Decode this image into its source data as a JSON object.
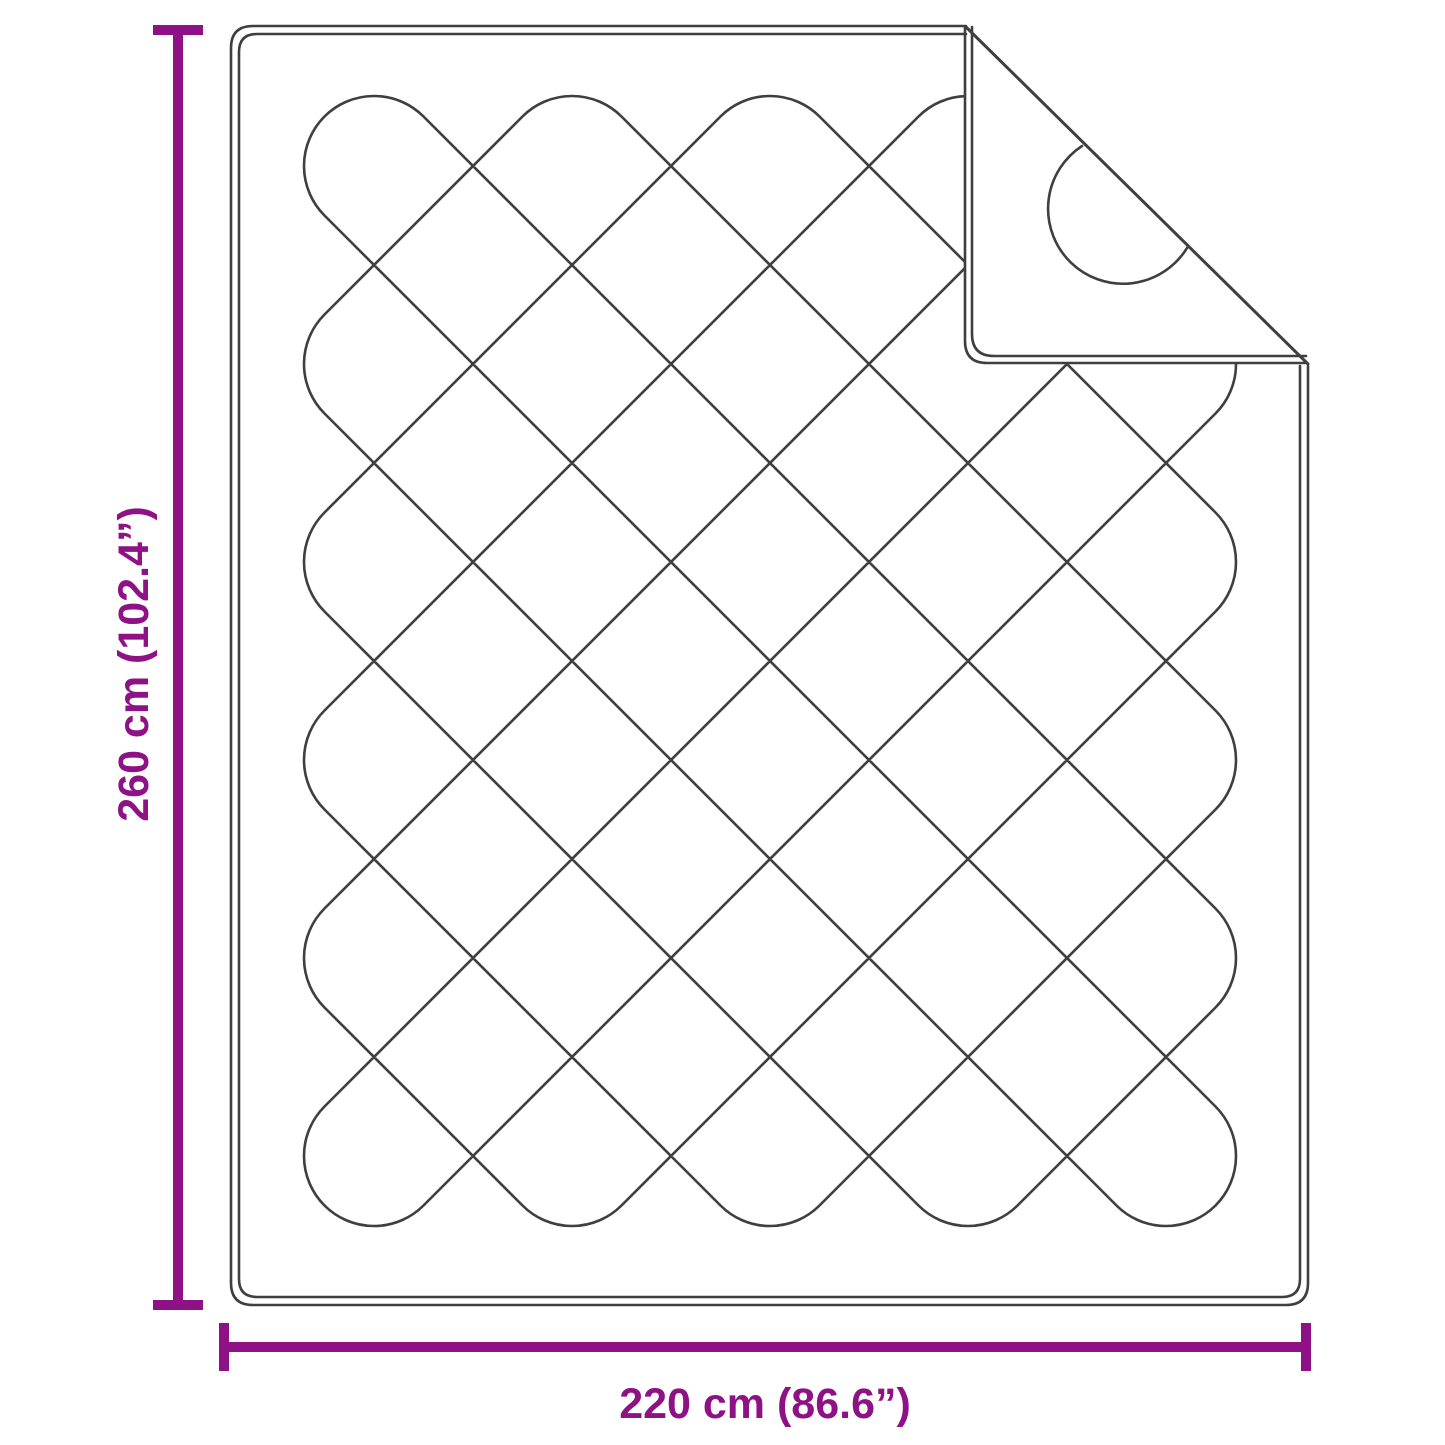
{
  "diagram": {
    "subject": "quilted-blanket-top-view-with-folded-corner",
    "height_dimension": {
      "label": "260 cm (102.4”)",
      "value_cm": 260,
      "value_inches": 102.4
    },
    "width_dimension": {
      "label": "220 cm (86.6”)",
      "value_cm": 220,
      "value_inches": 86.6
    }
  },
  "colors": {
    "dimension_annotation": "#8E1285",
    "drawing_line": "#3F3F3F",
    "background": "#FFFFFF"
  }
}
